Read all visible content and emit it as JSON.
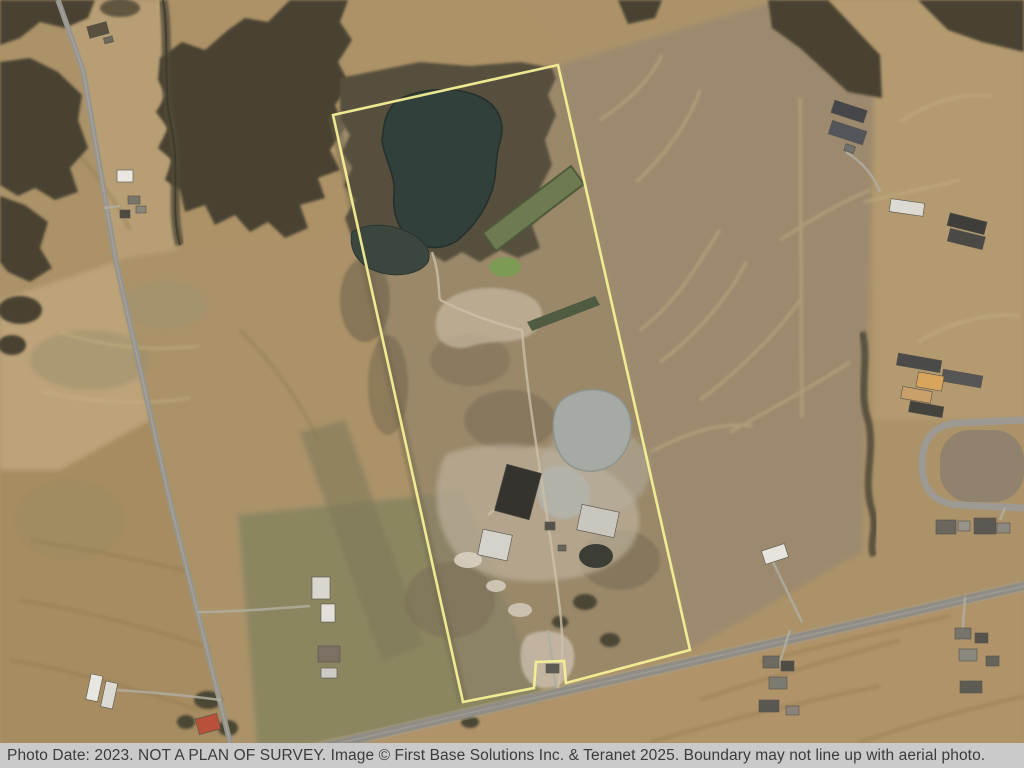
{
  "view": {
    "type": "aerial-photo-with-parcel-overlay",
    "width": 1024,
    "height": 768
  },
  "boundary": {
    "name": "property-boundary",
    "color": "#f5f096",
    "points": "333,115 558,65 690,650 566,683 564,661 536,662 534,688 463,702"
  },
  "caption": {
    "background": "#cacaca",
    "text_color": "#3b3b3b",
    "text": "Photo Date: 2023. NOT A PLAN OF SURVEY. Image © First Base Solutions Inc. & Teranet 2025. Boundary may not line up with aerial photo."
  },
  "features": {
    "ponds": [
      "large-dark-pond",
      "small-dark-pond",
      "green-lagoon",
      "small-green-pond",
      "narrow-lagoon",
      "gray-sludge-pond",
      "dark-round-pond"
    ],
    "roads": [
      "left-concession-road",
      "main-bottom-road",
      "cul-de-sac-loop"
    ],
    "vegetation": [
      "top-left-woods",
      "top-middle-woods",
      "parcel-north-scrub",
      "top-right-tree-band",
      "creek-treeline",
      "east-hedgerow"
    ],
    "structures": [
      "farmsteads-along-roads",
      "parcel-buildings",
      "silos",
      "red-roof-house"
    ]
  },
  "colors": {
    "field_tan": "#ab9269",
    "field_light": "#bfa67c",
    "field_green": "#8c8660",
    "forest_dark": "#4a4332",
    "road_gray": "#8f8d86",
    "pond_dark": "#31403a",
    "sludge_gray": "#a6aaa4"
  }
}
